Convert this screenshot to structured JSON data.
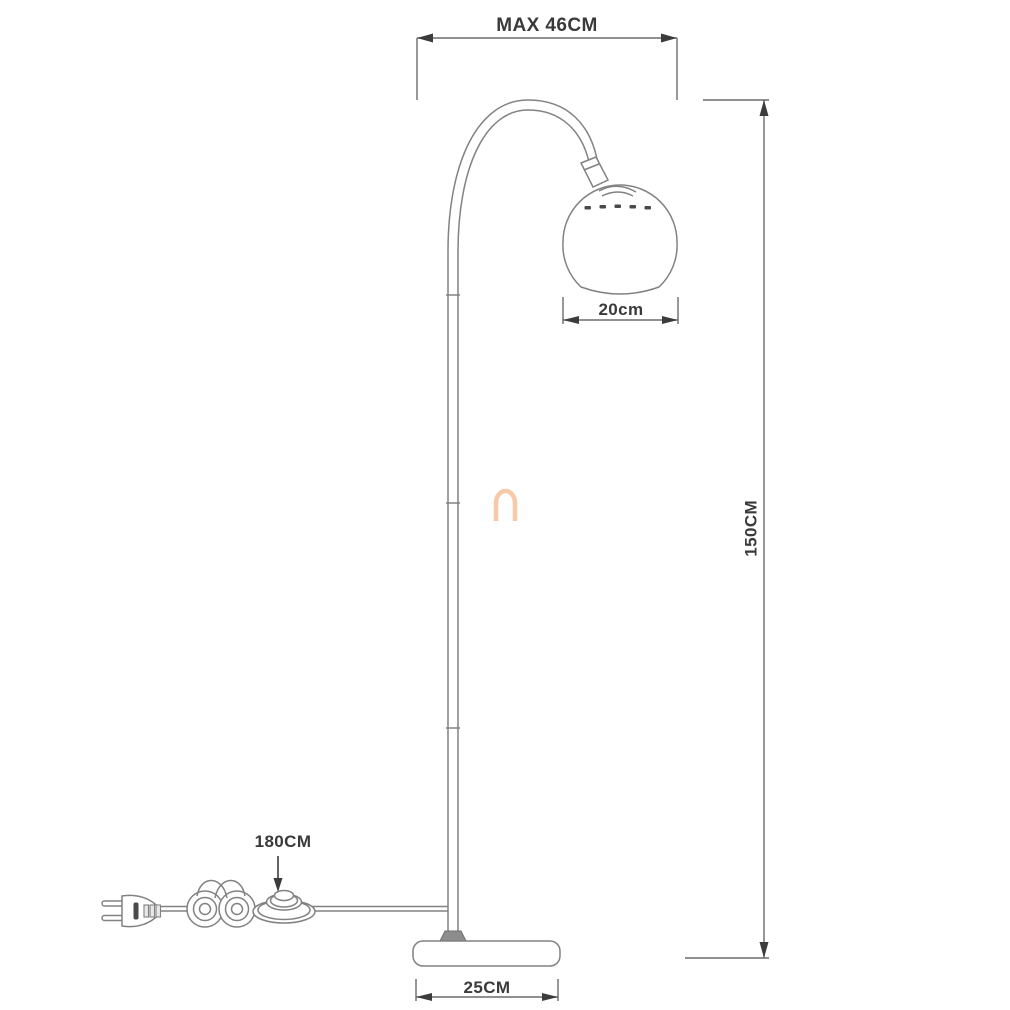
{
  "diagram": {
    "title": "Arc floor lamp technical dimension drawing",
    "dimensions": {
      "arm_reach": "MAX 46CM",
      "height": "150CM",
      "shade_diameter": "20cm",
      "cord_length": "180CM",
      "base_width": "25CM"
    },
    "colors": {
      "background": "#ffffff",
      "line": "#828282",
      "dimension_line": "#6b6b6b",
      "arrow": "#3c3c3c",
      "text": "#3a3a3a",
      "watermark": "#f8c9a8"
    }
  }
}
